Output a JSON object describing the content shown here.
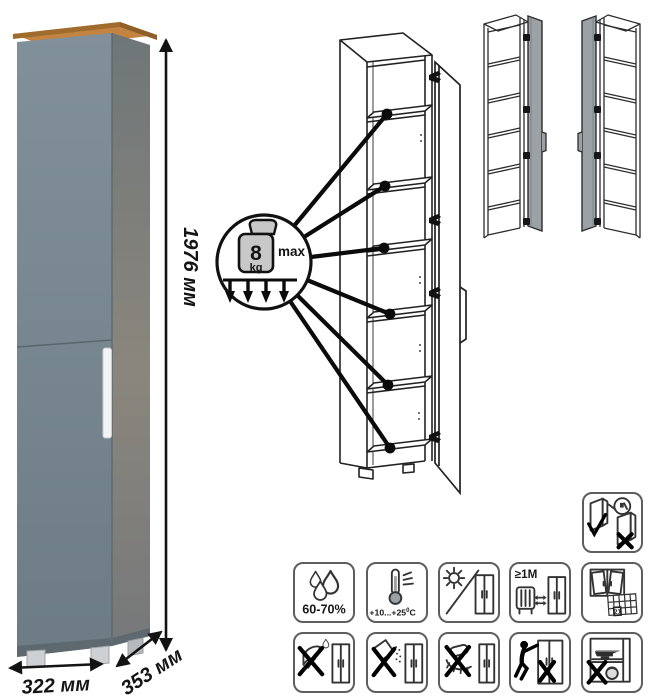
{
  "product": {
    "type": "tall-narrow-cabinet",
    "dimensions": {
      "height": "1976 мм",
      "width": "322 мм",
      "depth": "353 мм"
    },
    "colors": {
      "front_top": "#7f8d93",
      "front_bottom": "#6d7c84",
      "side_top": "#6e7578",
      "side_bottom": "#878379",
      "top_wood": "#c28440",
      "top_wood_edge": "#9c6a2e",
      "handle": "#f2f3f4",
      "feet": "#c9cdcf",
      "line": "#131313"
    }
  },
  "load_callout": {
    "value": "8",
    "unit": "kg",
    "qualifier": "max",
    "shelves_marked": 6
  },
  "variant_views": [
    {
      "name": "door-hinged-right-variant"
    },
    {
      "name": "door-hinged-left-variant"
    }
  ],
  "care_icons": {
    "standalone": {
      "icon": "door-mounting-check-icon"
    },
    "row1": [
      {
        "icon": "humidity-icon",
        "label": "60-70%"
      },
      {
        "icon": "temperature-range-icon",
        "label": "+10...+25",
        "sup": "0",
        "unit": "C"
      },
      {
        "icon": "no-direct-sunlight-icon"
      },
      {
        "icon": "heat-source-distance-icon",
        "label": "≥1М"
      },
      {
        "icon": "ventilation-calendar-icon",
        "calendar_day": "21"
      }
    ],
    "row2": [
      {
        "icon": "no-sharp-tools-icon"
      },
      {
        "icon": "no-abrasive-cleaning-icon"
      },
      {
        "icon": "no-wet-sponge-icon"
      },
      {
        "icon": "no-dragging-icon"
      },
      {
        "icon": "no-heavy-objects-icon"
      }
    ]
  }
}
